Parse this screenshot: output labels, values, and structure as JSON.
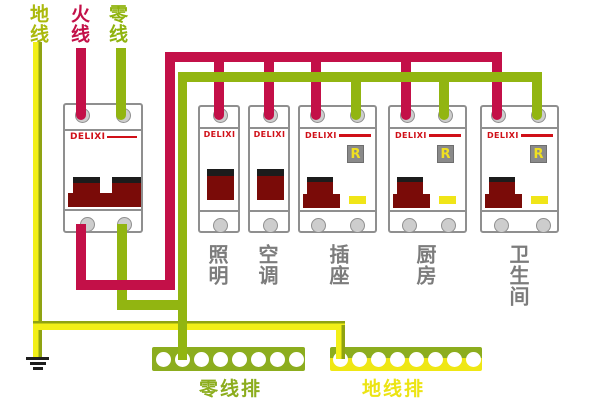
{
  "legend": {
    "ground_wire": "地线",
    "live_wire": "火线",
    "neutral_wire": "零线"
  },
  "breakers": {
    "main": {
      "brand": "DELIXI"
    },
    "circuits": [
      {
        "label": "照明",
        "brand": "DELIXI",
        "type": "single-pole"
      },
      {
        "label": "空调",
        "brand": "DELIXI",
        "type": "single-pole"
      },
      {
        "label": "插座",
        "brand": "DELIXI",
        "type": "rcd",
        "badge": "R"
      },
      {
        "label": "厨房",
        "brand": "DELIXI",
        "type": "rcd",
        "badge": "R"
      },
      {
        "label": "卫生间",
        "brand": "DELIXI",
        "type": "rcd",
        "badge": "R"
      }
    ]
  },
  "bus_bars": {
    "neutral": {
      "label": "零线排",
      "holes": 8
    },
    "ground": {
      "label": "地线排",
      "holes": 8
    }
  },
  "colors": {
    "live": "#c31048",
    "neutral_green": "#92b511",
    "ground_yellow": "#f2ef17",
    "bar_olive": "#8cad1e",
    "toggle_dark_red": "#7a0b08",
    "brand_red": "#d01018",
    "label_gray": "#7c7c7c"
  }
}
